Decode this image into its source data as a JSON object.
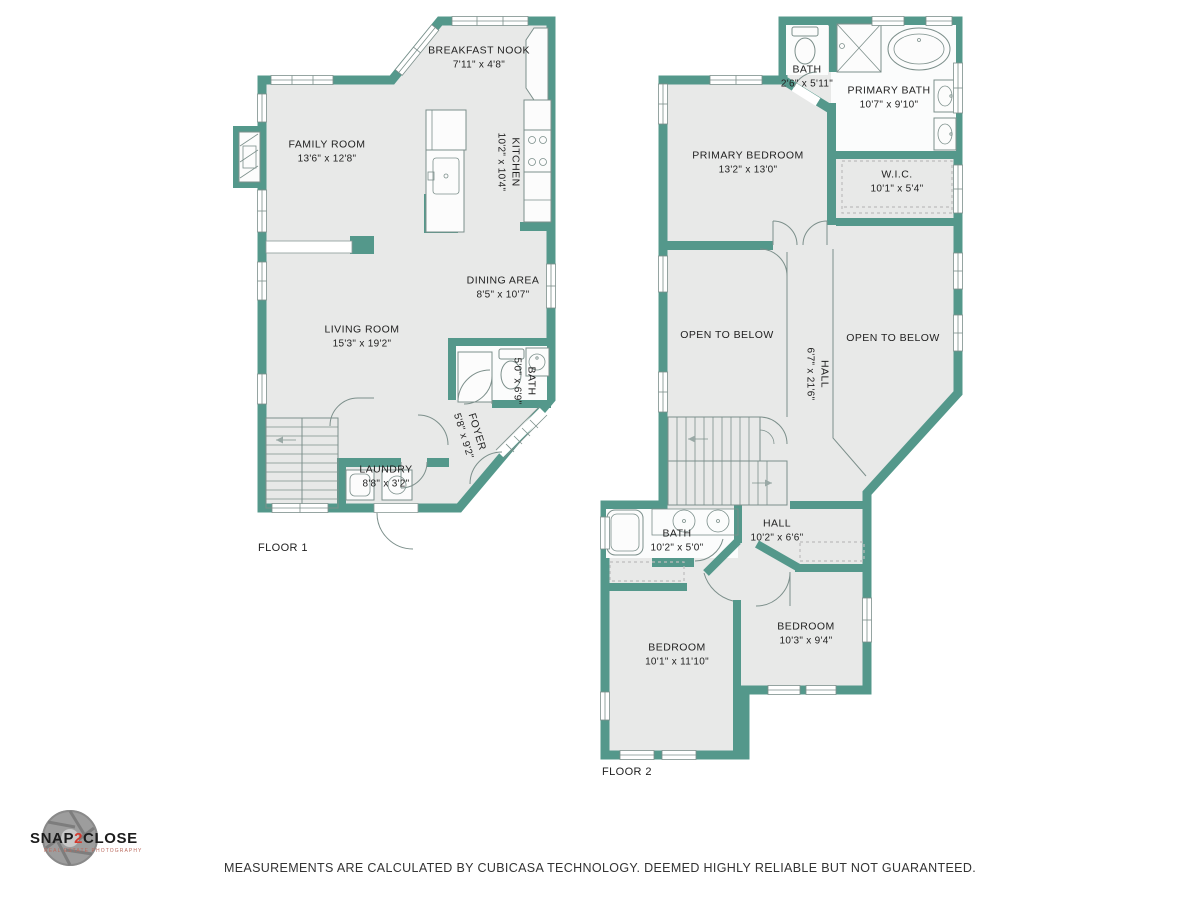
{
  "colors": {
    "wall": "#54988b",
    "floor": "#e8e9e8",
    "line": "#7c8f8b",
    "dash": "#bdbdbd",
    "text": "#1f1f1f",
    "white": "#fcfcfc",
    "logo_red": "#d43a2f"
  },
  "floor1": {
    "label": "FLOOR 1",
    "rooms": [
      {
        "name": "BREAKFAST NOOK",
        "dims": "7'11\" x 4'8\""
      },
      {
        "name": "FAMILY ROOM",
        "dims": "13'6\" x 12'8\""
      },
      {
        "name": "KITCHEN",
        "dims": "10'2\" x 10'4\""
      },
      {
        "name": "DINING AREA",
        "dims": "8'5\" x 10'7\""
      },
      {
        "name": "LIVING ROOM",
        "dims": "15'3\" x 19'2\""
      },
      {
        "name": "BATH",
        "dims": "5'0\" x 6'9\""
      },
      {
        "name": "FOYER",
        "dims": "5'8\" x 9'2\""
      },
      {
        "name": "LAUNDRY",
        "dims": "8'8\" x 3'2\""
      }
    ]
  },
  "floor2": {
    "label": "FLOOR 2",
    "rooms": [
      {
        "name": "BATH",
        "dims": "2'6\" x 5'11\""
      },
      {
        "name": "PRIMARY BATH",
        "dims": "10'7\" x 9'10\""
      },
      {
        "name": "PRIMARY BEDROOM",
        "dims": "13'2\" x 13'0\""
      },
      {
        "name": "W.I.C.",
        "dims": "10'1\" x 5'4\""
      },
      {
        "name": "OPEN TO BELOW",
        "dims": ""
      },
      {
        "name": "OPEN TO BELOW",
        "dims": ""
      },
      {
        "name": "HALL",
        "dims": "6'7\" x 21'6\""
      },
      {
        "name": "BATH",
        "dims": "10'2\" x 5'0\""
      },
      {
        "name": "HALL",
        "dims": "10'2\" x 6'6\""
      },
      {
        "name": "BEDROOM",
        "dims": "10'1\" x 11'10\""
      },
      {
        "name": "BEDROOM",
        "dims": "10'3\" x 9'4\""
      }
    ]
  },
  "logo": {
    "name_part1": "SNAP",
    "name_accent": "2",
    "name_part2": "CLOSE",
    "tagline": "REAL ESTATE PHOTOGRAPHY"
  },
  "footer": {
    "disclaimer": "MEASUREMENTS ARE CALCULATED BY CUBICASA TECHNOLOGY. DEEMED HIGHLY RELIABLE BUT NOT GUARANTEED."
  }
}
